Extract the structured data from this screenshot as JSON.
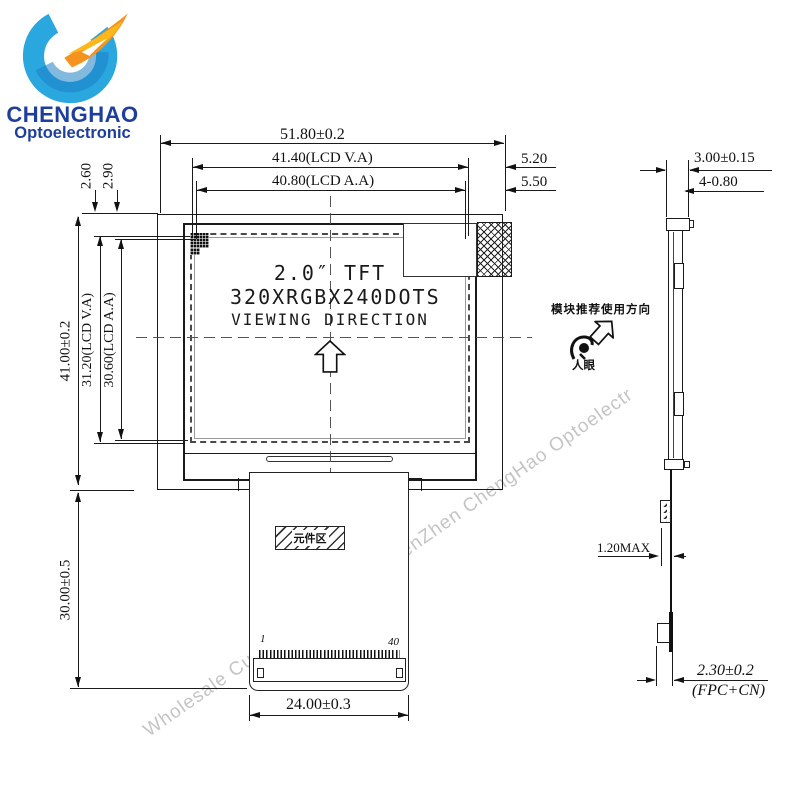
{
  "logo": {
    "name": "CHENGHAO",
    "subtitle": "Optoelectronic"
  },
  "watermark": "Wholesale Custom Small Size ShenZhen ChengHao Optoelectr",
  "front": {
    "line1": "2.0″ TFT",
    "line2": "320XRGBX240DOTS",
    "line3": "VIEWING DIRECTION",
    "component_area": "元件区",
    "pin_first": "1",
    "pin_last": "40",
    "dim_total_width": "51.80±0.2",
    "dim_va_width": "41.40(LCD V.A)",
    "dim_aa_width": "40.80(LCD A.A)",
    "dim_right_gap_va": "5.20",
    "dim_right_gap_aa": "5.50",
    "dim_top_gap_va": "2.60",
    "dim_top_gap_aa": "2.90",
    "dim_total_height": "41.00±0.2",
    "dim_va_height": "31.20(LCD V.A)",
    "dim_aa_height": "30.60(LCD A.A)",
    "dim_fpc_length": "30.00±0.5",
    "dim_connector_width": "24.00±0.3"
  },
  "side": {
    "dim_thickness": "3.00±0.15",
    "dim_hole": "4-0.80",
    "dim_fpc_max": "1.20MAX",
    "dim_bottom": "2.30±0.2",
    "dim_bottom_note": "(FPC+CN)",
    "usage_note": "模块推荐使用方向",
    "eye_label": "人眼"
  }
}
